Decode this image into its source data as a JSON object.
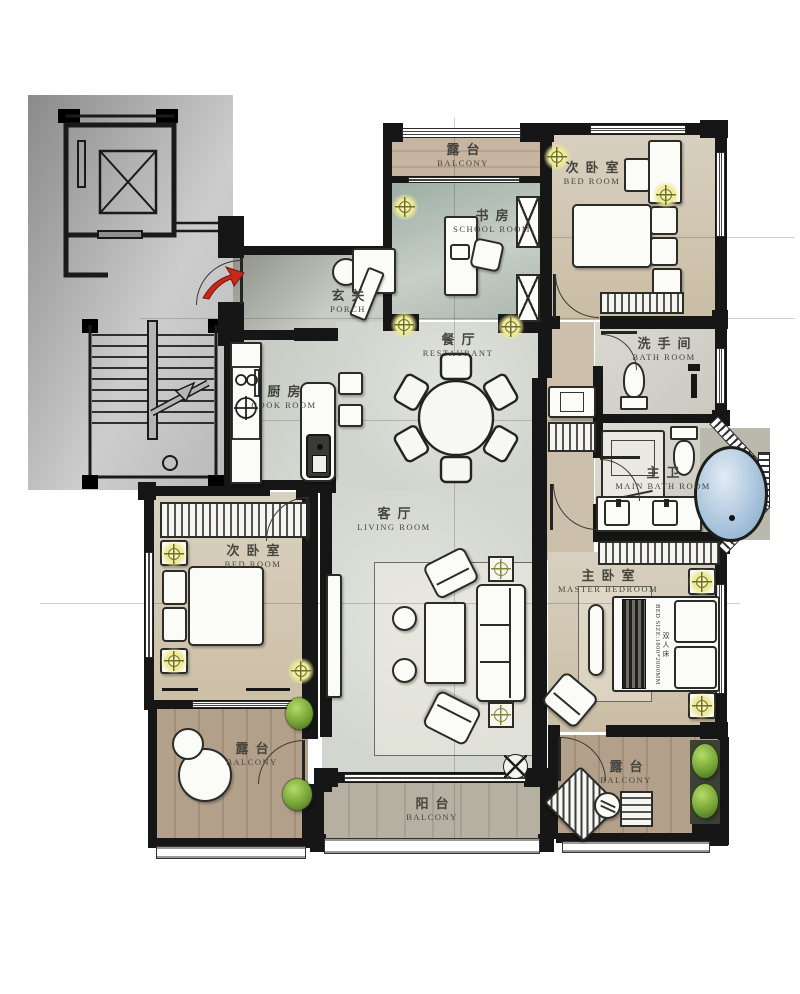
{
  "plan": {
    "rooms": {
      "balcony_top": {
        "cn": "露台",
        "en": "BALCONY"
      },
      "school_room": {
        "cn": "书房",
        "en": "SCHOOL ROOM"
      },
      "bedroom_top": {
        "cn": "次卧室",
        "en": "BED ROOM"
      },
      "porch": {
        "cn": "玄关",
        "en": "PORCH"
      },
      "restaurant": {
        "cn": "餐厅",
        "en": "RESTAURANT"
      },
      "kitchen": {
        "cn": "厨房",
        "en": "COOK ROOM"
      },
      "bathroom": {
        "cn": "洗手间",
        "en": "BATH ROOM"
      },
      "main_bathroom": {
        "cn": "主卫",
        "en": "MAIN BATH ROOM"
      },
      "living_room": {
        "cn": "客厅",
        "en": "LIVING ROOM"
      },
      "bedroom_left": {
        "cn": "次卧室",
        "en": "BED ROOM"
      },
      "master_bedroom": {
        "cn": "主卧室",
        "en": "MASTER BEDROOM"
      },
      "balcony_bl": {
        "cn": "露台",
        "en": "BALCONY"
      },
      "balcony_bc": {
        "cn": "阳台",
        "en": "BALCONY"
      },
      "balcony_br": {
        "cn": "露台",
        "en": "BALCONY"
      }
    },
    "master_bed": {
      "size_label": "BED SIZE:1800*2000MM",
      "type_label": "双人床"
    },
    "colors": {
      "wall": "#161616",
      "stair_block": "#9a9a9a",
      "marble_floor": "#d6d8d2",
      "bedroom_floor": "#d6cdba",
      "wood_balcony": "#b3a08a",
      "tub_water": "#a9c4dc",
      "plant_green": "#6f9e33",
      "lamp_glow": "#edea93",
      "entry_arrow_red": "#c6281b"
    }
  }
}
